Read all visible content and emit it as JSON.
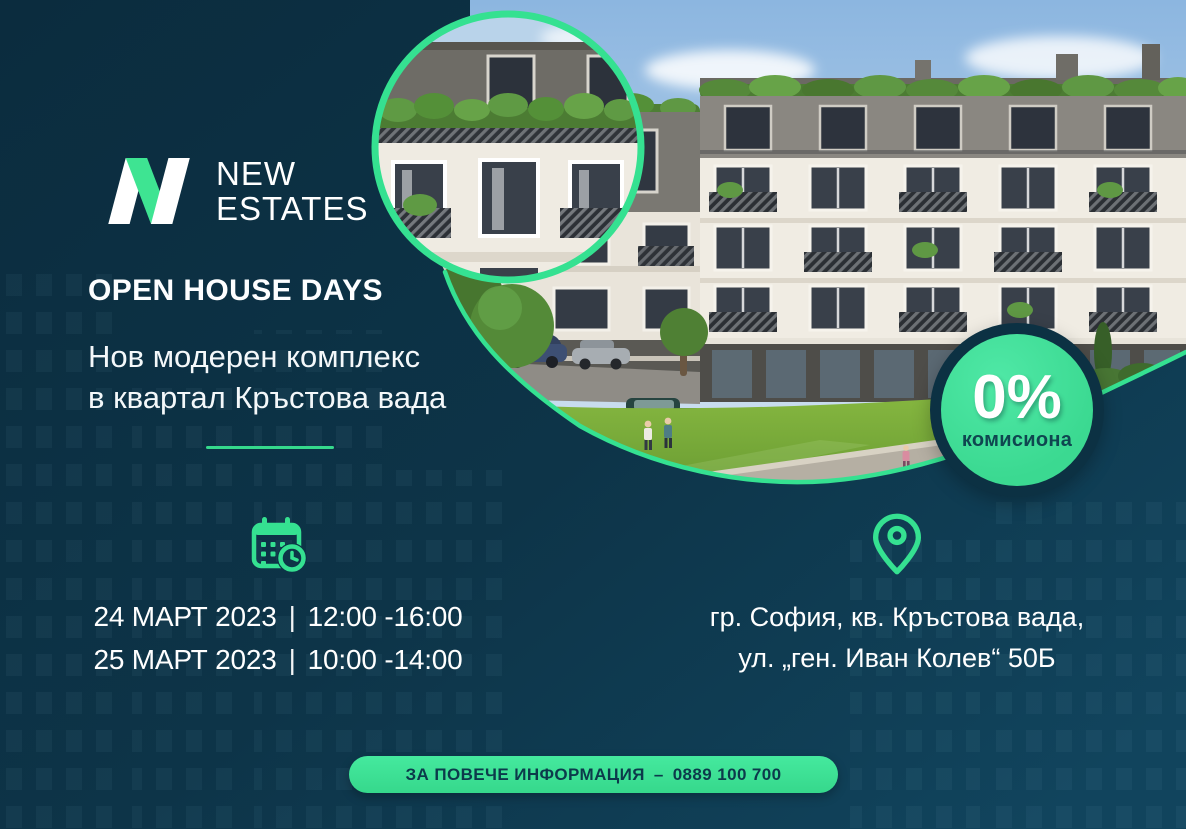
{
  "colors": {
    "background_dark": "#0d3448",
    "accent_green": "#35e191",
    "badge_green": "#41dd96",
    "button_green": "#3be795",
    "button_text_dark": "#0c3a4b",
    "badge_label_text": "#0f4650",
    "heading_text": "#ffffff"
  },
  "logo": {
    "mark": "n-monogram-icon",
    "name_line1": "NEW",
    "name_line2": "ESTATES"
  },
  "headline": "OPEN HOUSE DAYS",
  "subheadline": {
    "line1": "Нов модерен комплекс",
    "line2": "в квартал Кръстова вада"
  },
  "badge": {
    "value": "0%",
    "label": "комисиона"
  },
  "schedule": {
    "icon": "calendar-clock-icon",
    "rows": [
      {
        "date": "24 МАРТ 2023",
        "separator": "|",
        "time": "12:00 -16:00"
      },
      {
        "date": "25 МАРТ 2023",
        "separator": "|",
        "time": "10:00 -14:00"
      }
    ]
  },
  "location": {
    "icon": "map-pin-icon",
    "line1": "гр. София, кв. Кръстова вада,",
    "line2": "ул. „ген. Иван Колев“ 50Б"
  },
  "cta": {
    "label": "ЗА ПОВЕЧЕ ИНФОРМАЦИЯ",
    "separator": "–",
    "phone": "0889 100 700"
  }
}
